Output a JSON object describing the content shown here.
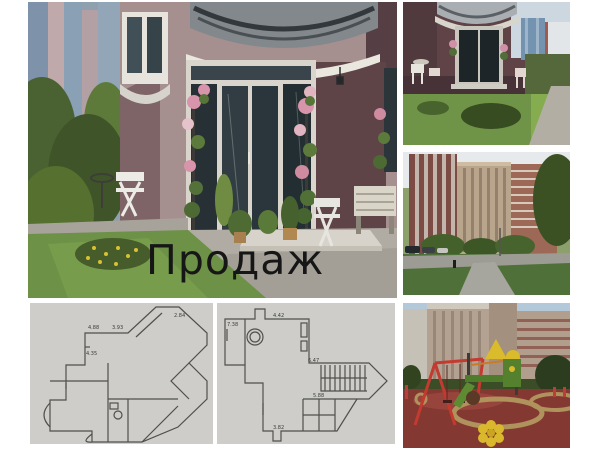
{
  "overlay": {
    "sale_label": "Продаж"
  },
  "floor_plans": {
    "left": {
      "dims": [
        "4.88",
        "3.93",
        "2.84",
        "4.35"
      ]
    },
    "right": {
      "dims": [
        "7.38",
        "4.42",
        "6.47",
        "5.88",
        "3.82"
      ]
    }
  },
  "colors": {
    "canvas_bg": "#ffffff",
    "overlay_text": "#161616",
    "wall_mauve": "#a5908f",
    "wall_maroon": "#5e4347",
    "grass_green": "#6d9146",
    "playground_rubber": "#833832",
    "swing_red": "#c23a30",
    "plan_background": "#cecdc9",
    "plan_line": "#4f4f4c"
  }
}
